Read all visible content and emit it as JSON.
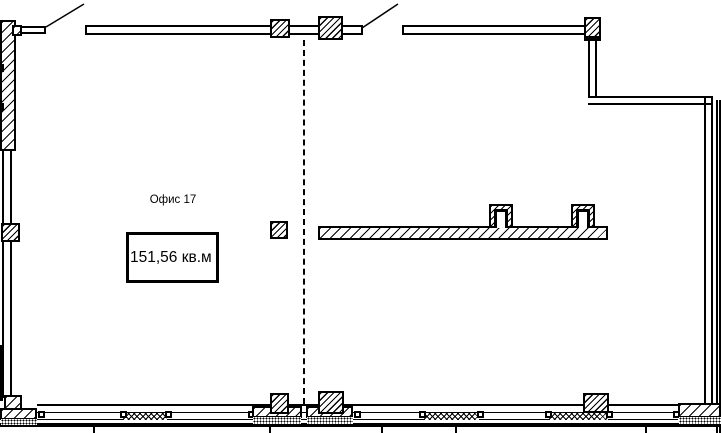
{
  "page": {
    "background_color": "#ffffff",
    "line_color": "#000000",
    "type": "architectural floor plan"
  },
  "plan": {
    "room_label": "Офис 17",
    "area_label": "151,56 кв.м"
  }
}
